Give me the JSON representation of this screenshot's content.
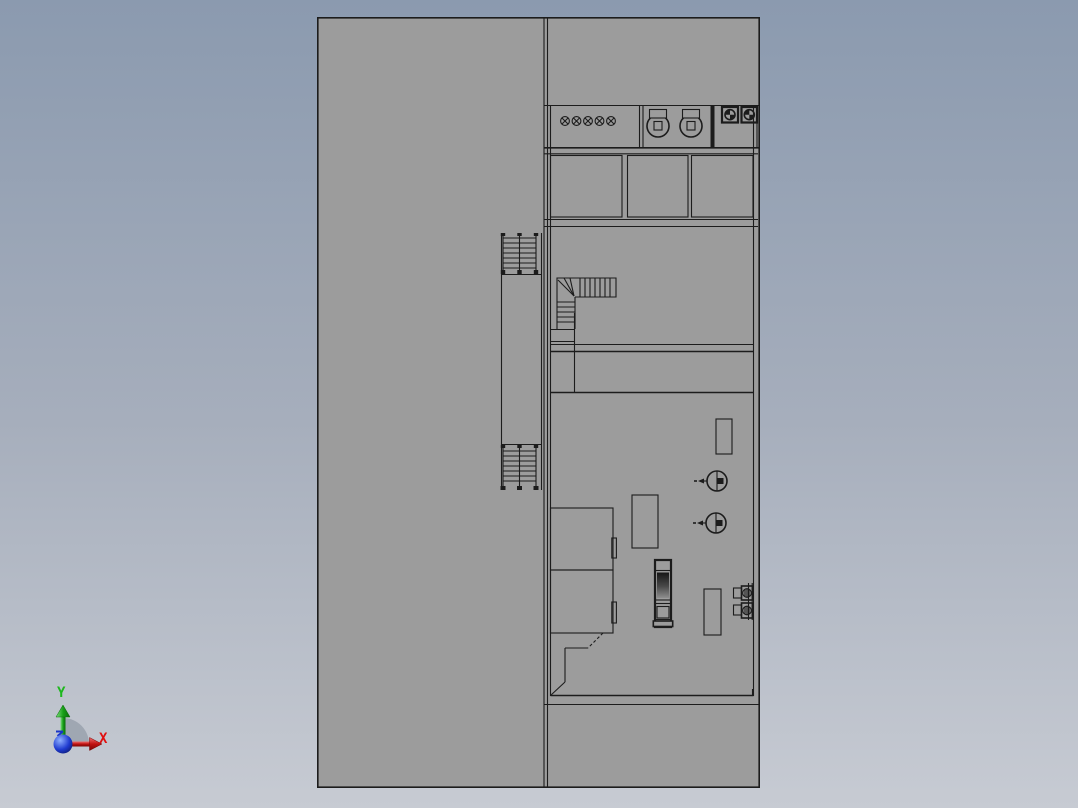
{
  "triad": {
    "x_label": "X",
    "y_label": "Y"
  },
  "colors": {
    "bg_top": "#8b9aaf",
    "bg_mid": "#a6aebc",
    "bg_bottom": "#c7cbd3",
    "model_fill": "#9c9c9c",
    "edge": "#1c1c1c",
    "x_axis": "#e01010",
    "y_axis": "#1db81d",
    "origin_blue": "#1a35c8",
    "shadow": "#99a1ad"
  }
}
